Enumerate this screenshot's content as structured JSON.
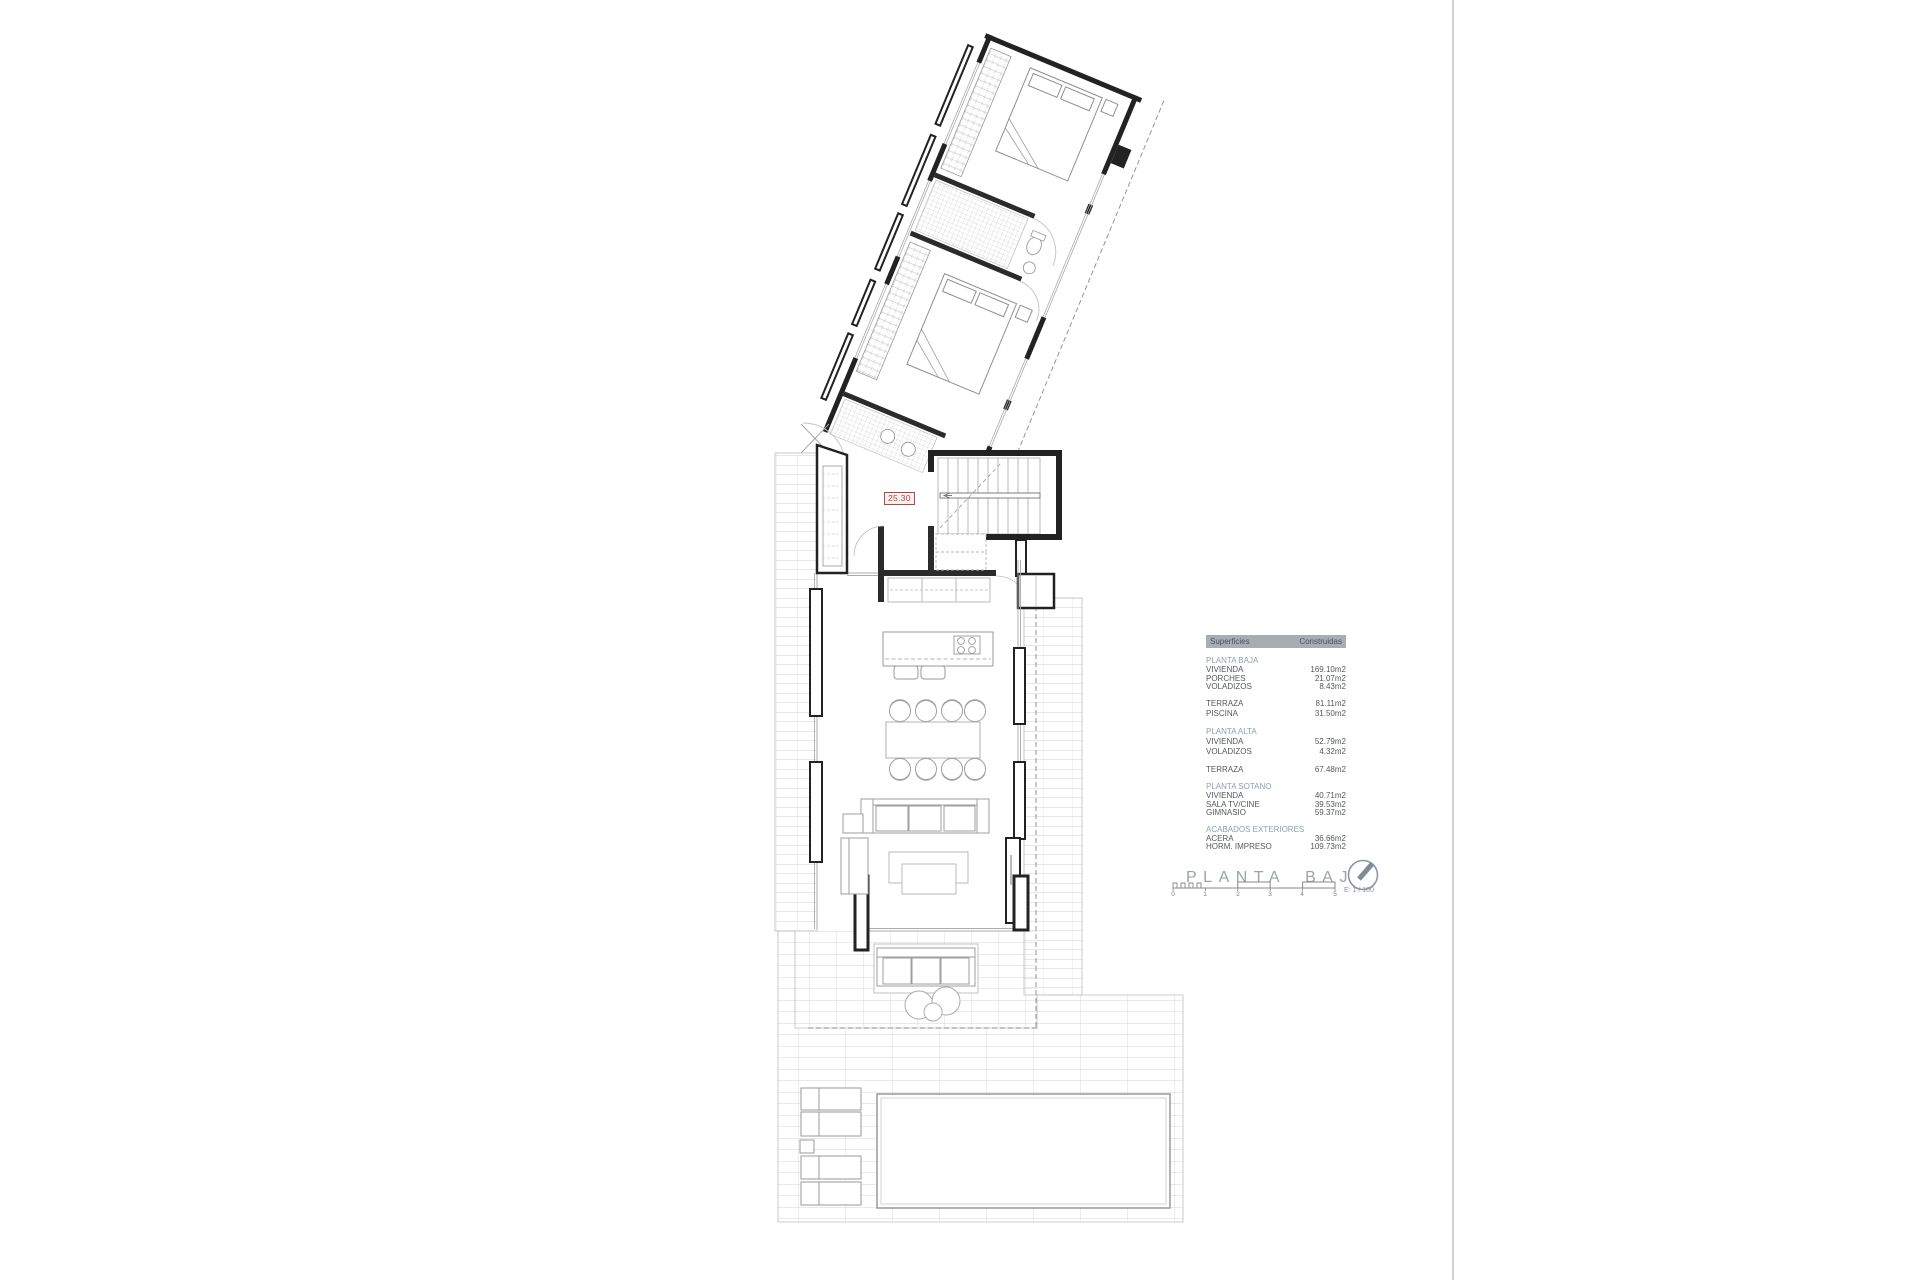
{
  "plan": {
    "level_label": "25.30"
  },
  "annotation": {
    "title": "PLANTA BAJA",
    "scale_text": "E: 1 / 100",
    "scale_ticks": [
      "0",
      "1",
      "2",
      "3",
      "4",
      "5"
    ]
  },
  "table": {
    "header": {
      "superficies": "Superficies",
      "construidas": "Construidas"
    },
    "sections": [
      {
        "title": "PLANTA BAJA",
        "rows": [
          [
            "VIVIENDA",
            "169.10m2"
          ],
          [
            "PORCHES",
            "21.07m2"
          ],
          [
            "VOLADIZOS",
            "8.43m2"
          ]
        ]
      },
      {
        "title": "",
        "rows": [
          [
            "TERRAZA",
            "81.11m2"
          ],
          [
            "PISCINA",
            "31.50m2"
          ]
        ]
      },
      {
        "title": "PLANTA ALTA",
        "rows": [
          [
            "VIVIENDA",
            "52.79m2"
          ],
          [
            "VOLADIZOS",
            "4.32m2"
          ]
        ]
      },
      {
        "title": "",
        "rows": [
          [
            "TERRAZA",
            "67.48m2"
          ]
        ]
      },
      {
        "title": "PLANTA SOTANO",
        "rows": [
          [
            "VIVIENDA",
            "40.71m2"
          ],
          [
            "SALA TV/CINE",
            "39.53m2"
          ],
          [
            "GIMNASIO",
            "59.37m2"
          ]
        ]
      },
      {
        "title": "ACABADOS EXTERIORES",
        "rows": [
          [
            "ACERA",
            "36.66m2"
          ],
          [
            "HORM. IMPRESO",
            "109.73m2"
          ]
        ]
      }
    ]
  },
  "colors": {
    "accent_red": "#a84b42",
    "table_header_bg": "#a9adb2",
    "table_header_text": "#47536b",
    "section_title": "#8aa2b4",
    "body_text": "#55595d",
    "muted_title": "#9ba2a9",
    "wall": "#222222",
    "light_line": "#b5b5b5"
  }
}
